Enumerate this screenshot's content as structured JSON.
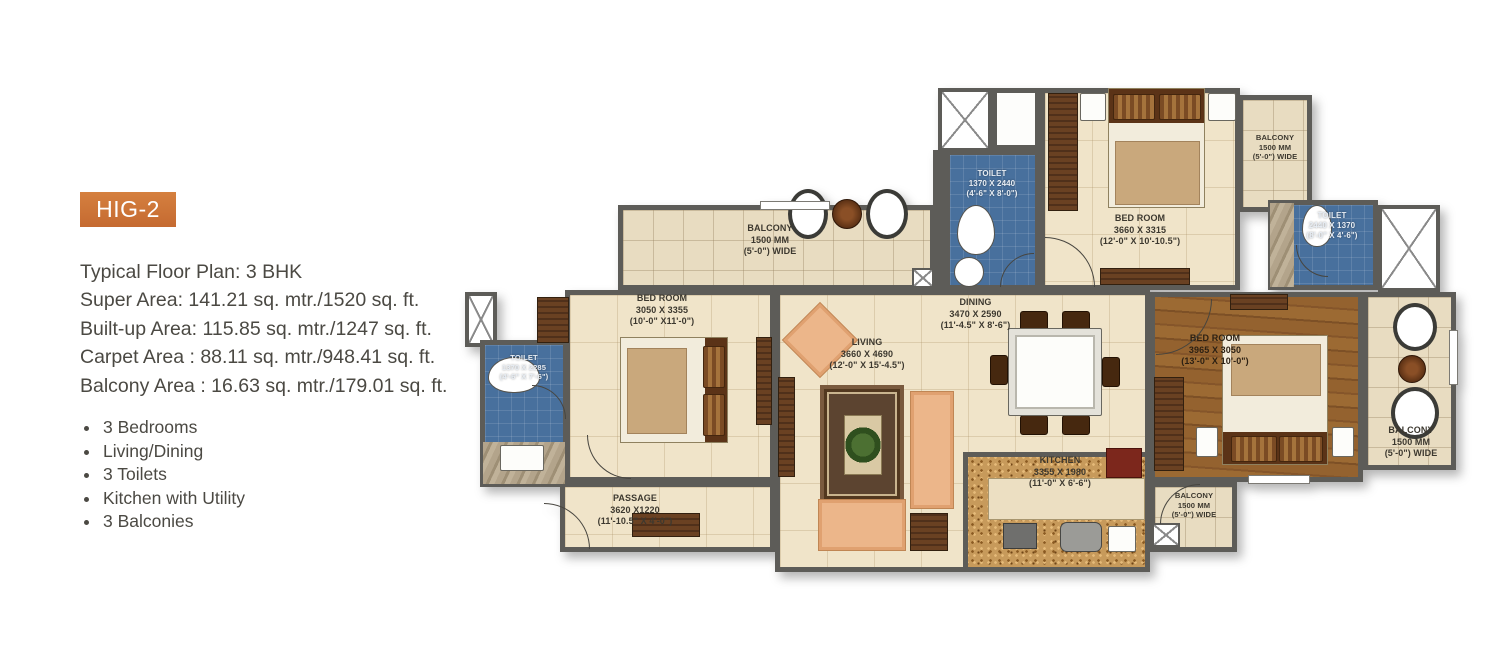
{
  "badge": {
    "label": "HIG-2"
  },
  "info": {
    "title": "Typical Floor Plan: 3 BHK",
    "lines": [
      "Super Area: 141.21 sq. mtr./1520 sq. ft.",
      "Built-up Area:  115.85 sq. mtr./1247 sq. ft.",
      "Carpet Area : 88.11 sq. mtr./948.41 sq. ft.",
      "Balcony Area : 16.63 sq. mtr./179.01 sq. ft."
    ],
    "features": [
      "3 Bedrooms",
      "Living/Dining",
      "3 Toilets",
      "Kitchen with Utility",
      "3 Balconies"
    ]
  },
  "rooms": {
    "bedroom_top": {
      "name": "BED ROOM",
      "mm": "3660 X 3315",
      "ft": "(12'-0\" X 10'-10.5\")"
    },
    "bedroom_left": {
      "name": "BED ROOM",
      "mm": "3050 X 3355",
      "ft": "(10'-0\" X11'-0\")"
    },
    "bedroom_right": {
      "name": "BED ROOM",
      "mm": "3965 X 3050",
      "ft": "(13'-0\" X 10'-0\")"
    },
    "toilet_top": {
      "name": "TOILET",
      "mm": "1370 X 2440",
      "ft": "(4'-6\" X 8'-0\")"
    },
    "toilet_right": {
      "name": "TOILET",
      "mm": "2440 X 1370",
      "ft": "(8'-0\" X 4'-6\")"
    },
    "toilet_left": {
      "name": "TOILET",
      "mm": "1370 X 2285",
      "ft": "(4'-6\" X 7'-6\")"
    },
    "living": {
      "name": "LIVING",
      "mm": "3660 X 4690",
      "ft": "(12'-0\" X 15'-4.5\")"
    },
    "dining": {
      "name": "DINING",
      "mm": "3470 X 2590",
      "ft": "(11'-4.5\" X 8'-6\")"
    },
    "kitchen": {
      "name": "KITCHEN",
      "mm": "3355 X 1980",
      "ft": "(11'-0\" X 6'-6\")"
    },
    "passage": {
      "name": "PASSAGE",
      "mm": "3620 X1220",
      "ft": "(11'-10.5\" X 4'-0\")"
    },
    "balcony_top": {
      "name": "BALCONY",
      "mm": "1500 MM",
      "ft": "(5'-0\") WIDE"
    },
    "balcony_ne": {
      "name": "BALCONY",
      "mm": "1500 MM",
      "ft": "(5'-0\") WIDE"
    },
    "balcony_east": {
      "name": "BALCONY",
      "mm": "1500 MM",
      "ft": "(5'-0\") WIDE"
    },
    "balcony_south": {
      "name": "BALCONY",
      "mm": "1500 MM",
      "ft": "(5'-0\") WIDE"
    }
  },
  "colors": {
    "accent": "#cb6f3a",
    "wall": "#5d5c58",
    "floor": "#f0e4c9",
    "toilet": "#48709d",
    "wood": "#8f5c2c"
  }
}
